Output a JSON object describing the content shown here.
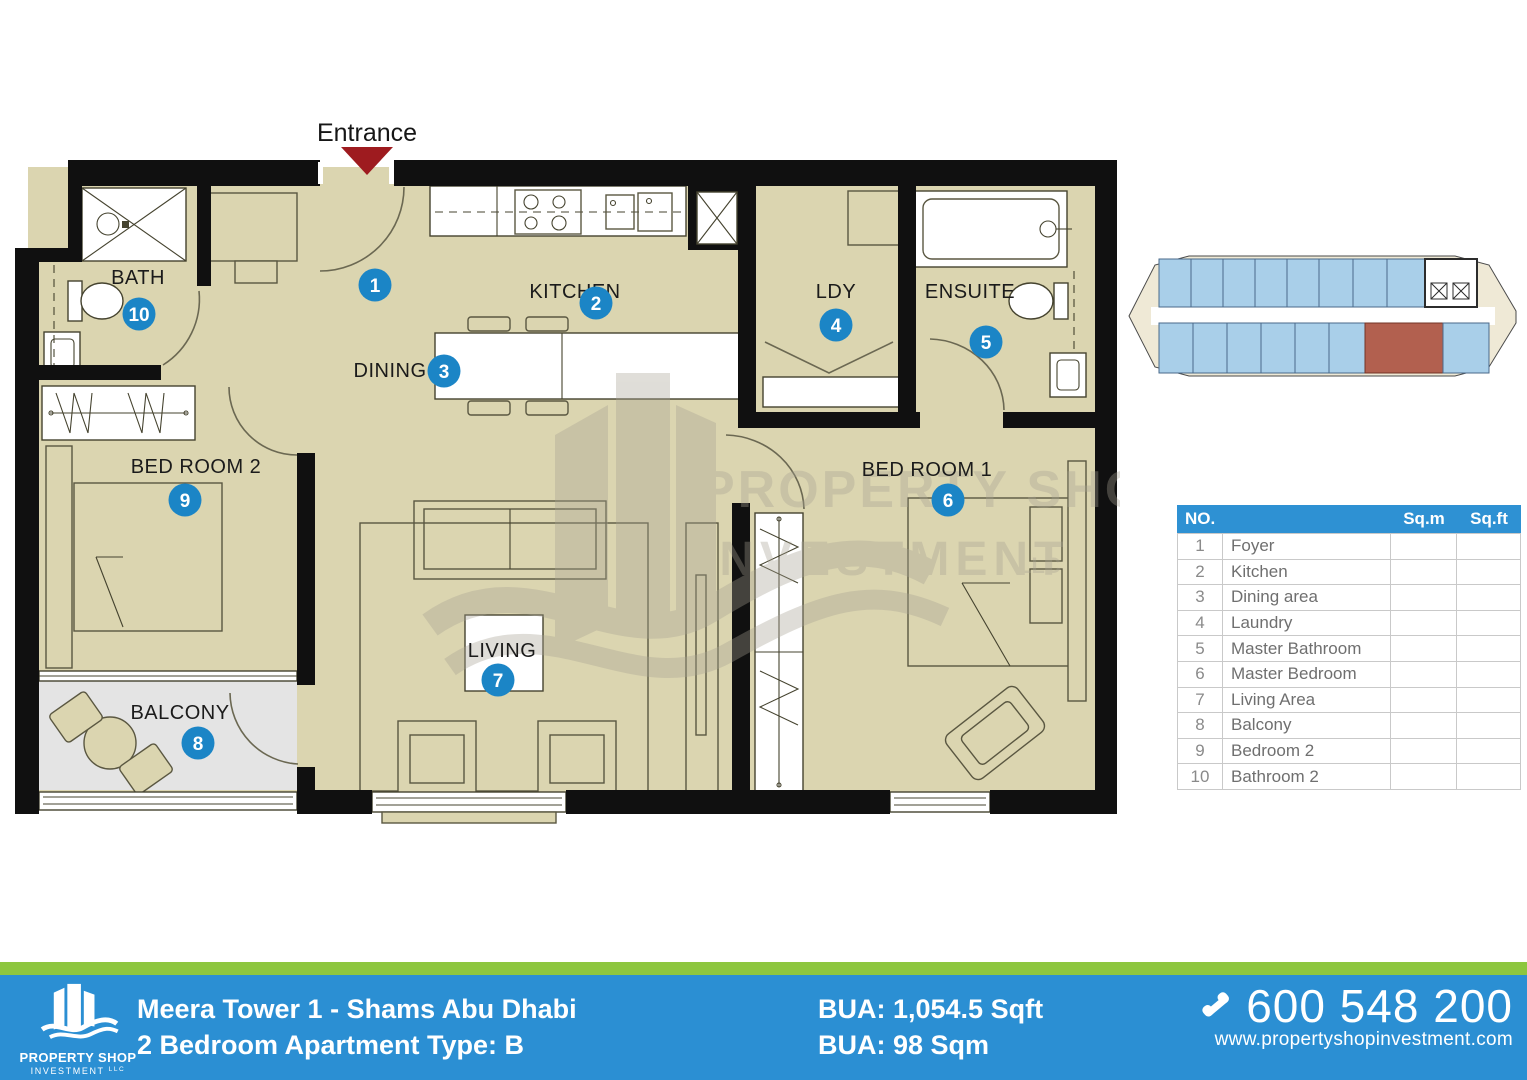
{
  "plan": {
    "entrance_label": "Entrance",
    "rooms": {
      "bath": "BATH",
      "kitchen": "KITCHEN",
      "dining": "DINING",
      "ldy": "LDY",
      "ensuite": "ENSUITE",
      "bedroom1": "BED ROOM 1",
      "bedroom2": "BED ROOM 2",
      "living": "LIVING",
      "balcony": "BALCONY"
    },
    "markers": {
      "foyer": "1",
      "kitchen": "2",
      "dining": "3",
      "laundry": "4",
      "master_bathroom": "5",
      "master_bedroom": "6",
      "living": "7",
      "balcony": "8",
      "bedroom2": "9",
      "bathroom2": "10"
    }
  },
  "watermark": {
    "line1": "PROPERTY SHOP",
    "line2": "INVESTMENT",
    "suffix": "LLC"
  },
  "area_table": {
    "col_no": "NO.",
    "col_sqm": "Sq.m",
    "col_sqft": "Sq.ft",
    "rows": [
      {
        "no": "1",
        "name": "Foyer",
        "sqm": "",
        "sqft": ""
      },
      {
        "no": "2",
        "name": "Kitchen",
        "sqm": "",
        "sqft": ""
      },
      {
        "no": "3",
        "name": "Dining area",
        "sqm": "",
        "sqft": ""
      },
      {
        "no": "4",
        "name": "Laundry",
        "sqm": "",
        "sqft": ""
      },
      {
        "no": "5",
        "name": "Master Bathroom",
        "sqm": "",
        "sqft": ""
      },
      {
        "no": "6",
        "name": "Master Bedroom",
        "sqm": "",
        "sqft": ""
      },
      {
        "no": "7",
        "name": "Living Area",
        "sqm": "",
        "sqft": ""
      },
      {
        "no": "8",
        "name": "Balcony",
        "sqm": "",
        "sqft": ""
      },
      {
        "no": "9",
        "name": "Bedroom 2",
        "sqm": "",
        "sqft": ""
      },
      {
        "no": "10",
        "name": "Bathroom 2",
        "sqm": "",
        "sqft": ""
      }
    ]
  },
  "footer": {
    "brand": {
      "name": "PROPERTY SHOP",
      "sub": "INVESTMENT",
      "suffix": "LLC"
    },
    "project_title": "Meera Tower 1 - Shams Abu Dhabi",
    "unit_title": "2 Bedroom Apartment Type: B",
    "bua_sqft": "BUA: 1,054.5 Sqft",
    "bua_sqm": "BUA: 98 Sqm",
    "phone": "600 548 200",
    "website": "www.propertyshopinvestment.com"
  },
  "colors": {
    "footer_blue": "#2B8FD3",
    "footer_green": "#8DC63F",
    "table_header_blue": "#2E91D3",
    "marker_blue": "#1B85C6",
    "floor_beige": "#DBD5B0",
    "balcony_grey": "#E4E4E4",
    "wall_black": "#101010",
    "entrance_red": "#9E1B1F",
    "unit_red": "#B2604F",
    "unit_blue": "#A9CFE9"
  }
}
